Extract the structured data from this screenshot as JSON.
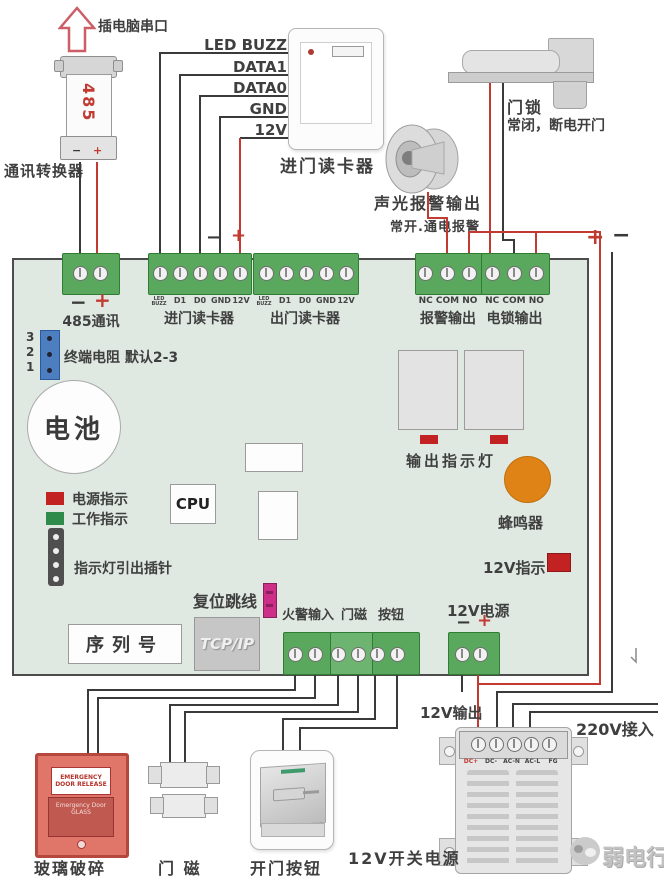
{
  "symbols": {
    "plus": "+",
    "minus": "−"
  },
  "top": {
    "arrow_label": "插电脑串口",
    "converter_num": "485",
    "converter_label": "通讯转换器"
  },
  "rails": [
    "LED BUZZ",
    "DATA1",
    "DATA0",
    "GND",
    "12V"
  ],
  "entry_reader": {
    "label": "进门读卡器"
  },
  "lock_dev": {
    "label": "门锁",
    "note": "常闭，断电开门"
  },
  "siren": {
    "label": "声光报警输出",
    "note": "常开.通电报警"
  },
  "board": {
    "t485": {
      "name": "485通讯"
    },
    "entry": {
      "pins": [
        "LED BUZZ",
        "D1",
        "D0",
        "GND",
        "12V"
      ],
      "name": "进门读卡器"
    },
    "exit": {
      "pins": [
        "LED BUZZ",
        "D1",
        "D0",
        "GND",
        "12V"
      ],
      "name": "出门读卡器"
    },
    "alarm": {
      "pins": "NC COM NO",
      "name": "报警输出"
    },
    "lockout": {
      "pins": "NC COM NO",
      "name": "电锁输出"
    },
    "jumper": {
      "pins": [
        "3",
        "2",
        "1"
      ],
      "label": "终端电阻 默认2-3"
    },
    "battery": "电池",
    "leds": {
      "power": "电源指示",
      "run": "工作指示"
    },
    "pin_header": "指示灯引出插针",
    "cpu": "CPU",
    "reset": "复位跳线",
    "serial": "序列号",
    "tcpip": "TCP/IP",
    "output_leds": "输出指示灯",
    "buzzer": "蜂鸣器",
    "v12_led": "12V指示",
    "v12_power": "12V电源",
    "fire": "火警输入",
    "door_sensor": "门磁",
    "button": "按钮"
  },
  "bottom": {
    "glass": {
      "label": "玻璃破碎",
      "line1": "EMERGENCY",
      "line2": "DOOR RELEASE",
      "panel": "Emergency Door GLASS"
    },
    "magnet_label": "门 磁",
    "exit_label": "开门按钮"
  },
  "psu": {
    "label": "12V开关电源",
    "pins": [
      "DC+",
      "DC-",
      "AC-N",
      "AC-L",
      "FG"
    ],
    "out_label": "12V输出",
    "ac_label": "220V接入"
  },
  "watermark": {
    "text": "弱电行业网"
  }
}
